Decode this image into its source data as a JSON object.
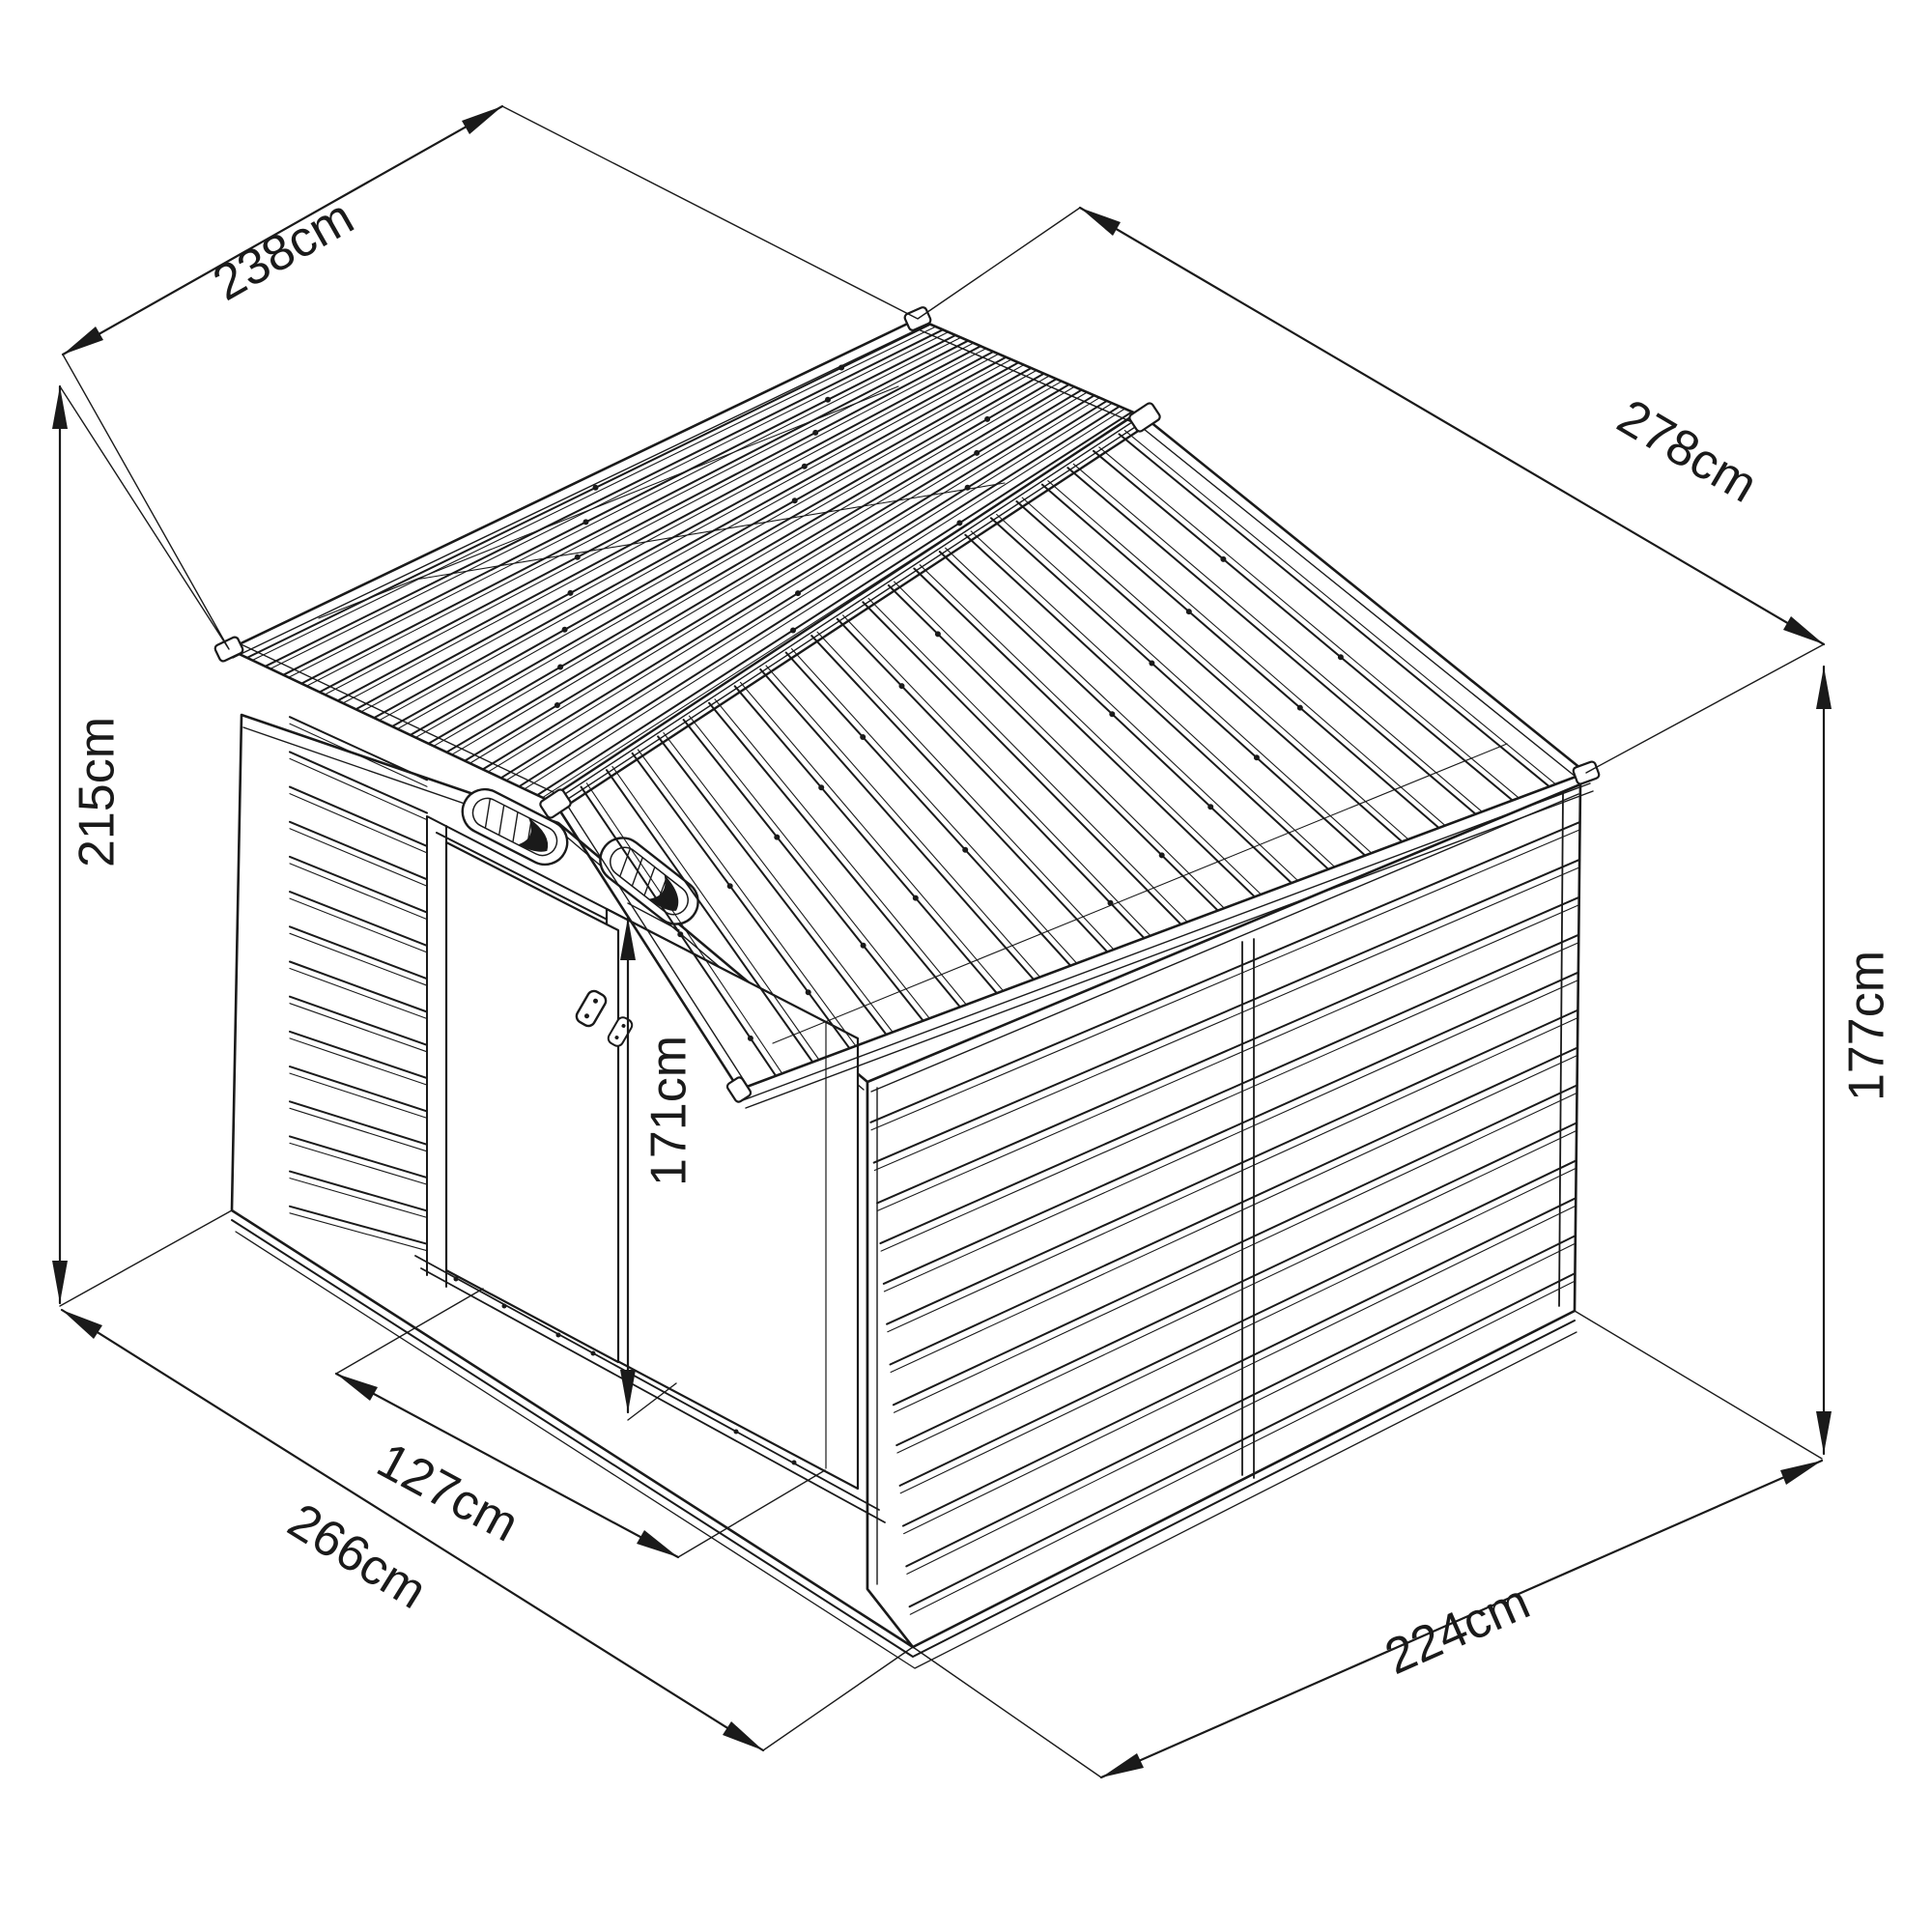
{
  "diagram": {
    "type": "isometric-line-drawing",
    "subject": "metal garden shed with overall dimensions",
    "background": "#ffffff",
    "line_color": "#1a1a1a"
  },
  "dimensions": {
    "roof_width": {
      "label": "238cm"
    },
    "roof_slope_length": {
      "label": "278cm"
    },
    "total_height": {
      "label": "215cm"
    },
    "wall_height": {
      "label": "177cm"
    },
    "door_height": {
      "label": "171cm"
    },
    "door_width": {
      "label": "127cm"
    },
    "base_front_width": {
      "label": "266cm"
    },
    "base_side_depth": {
      "label": "224cm"
    }
  }
}
